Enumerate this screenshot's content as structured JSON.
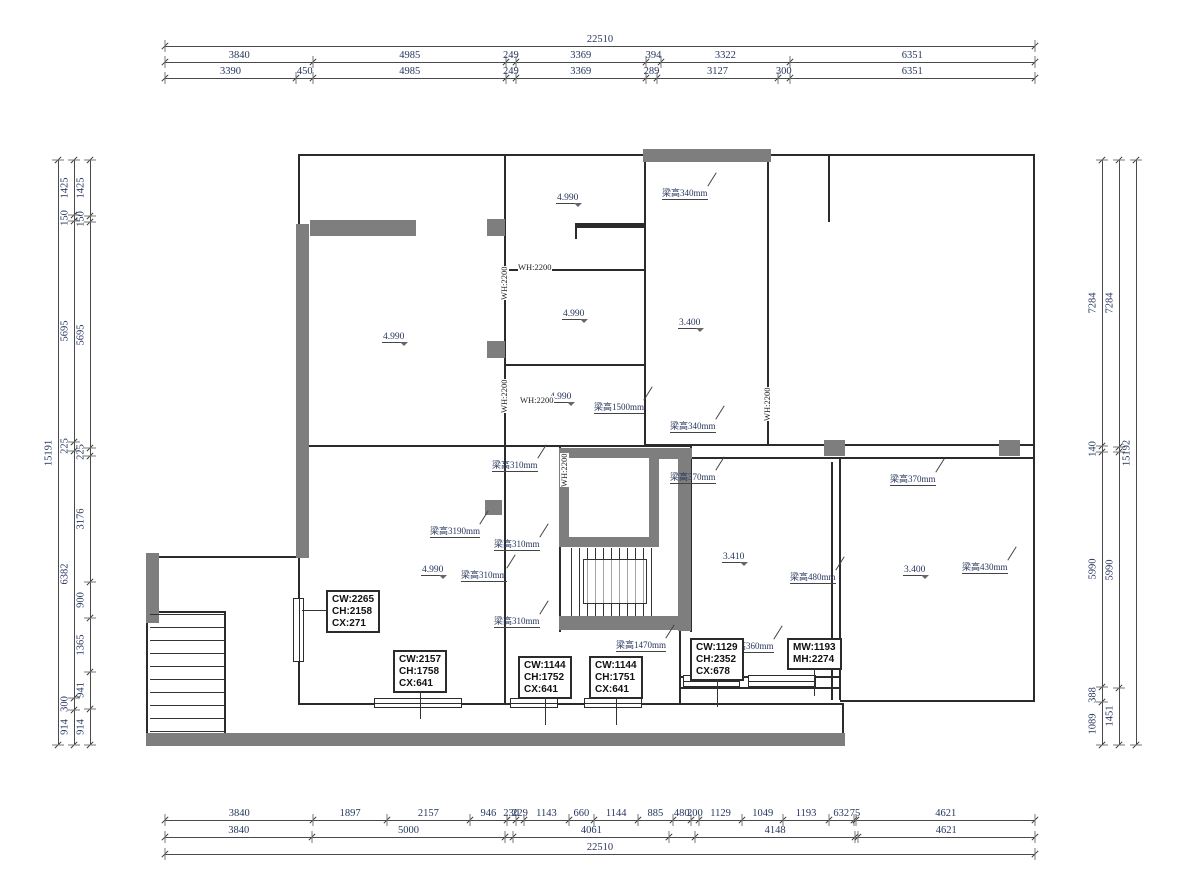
{
  "title": "residential floor plan working drawing",
  "colors": {
    "wall": "#2b2b2b",
    "poche": "#7e7e7e",
    "dim_text": "#26365e",
    "box_border": "#2b2b2b"
  },
  "dims": {
    "top": [
      {
        "name": "top-overall",
        "x": 165,
        "y": 46,
        "len": 870,
        "segments": [
          {
            "label": "22510",
            "size": 22510
          }
        ]
      },
      {
        "name": "top-row-2",
        "x": 165,
        "y": 62,
        "len": 870,
        "segments": [
          {
            "label": "3840",
            "size": 3840
          },
          {
            "label": "4985",
            "size": 4985
          },
          {
            "label": "249",
            "size": 249
          },
          {
            "label": "3369",
            "size": 3369
          },
          {
            "label": "394",
            "size": 394
          },
          {
            "label": "3322",
            "size": 3322
          },
          {
            "label": "6351",
            "size": 6351
          }
        ]
      },
      {
        "name": "top-row-3",
        "x": 165,
        "y": 78,
        "len": 870,
        "segments": [
          {
            "label": "3390",
            "size": 3390
          },
          {
            "label": "450",
            "size": 450
          },
          {
            "label": "4985",
            "size": 4985
          },
          {
            "label": "249",
            "size": 249
          },
          {
            "label": "3369",
            "size": 3369
          },
          {
            "label": "289",
            "size": 289
          },
          {
            "label": "3127",
            "size": 3127
          },
          {
            "label": "300",
            "size": 300
          },
          {
            "label": "6351",
            "size": 6351
          }
        ]
      }
    ],
    "bottom": [
      {
        "name": "bottom-row-1",
        "x": 165,
        "y": 820,
        "len": 870,
        "segments": [
          {
            "label": "3840",
            "size": 3840
          },
          {
            "label": "1897",
            "size": 1897
          },
          {
            "label": "2157",
            "size": 2157
          },
          {
            "label": "946",
            "size": 946
          },
          {
            "label": "230",
            "size": 230
          },
          {
            "label": "229",
            "size": 229
          },
          {
            "label": "1143",
            "size": 1143
          },
          {
            "label": "660",
            "size": 660
          },
          {
            "label": "1144",
            "size": 1144
          },
          {
            "label": "885",
            "size": 885
          },
          {
            "label": "480",
            "size": 480
          },
          {
            "label": "200",
            "size": 200
          },
          {
            "label": "1129",
            "size": 1129
          },
          {
            "label": "1049",
            "size": 1049
          },
          {
            "label": "1193",
            "size": 1193
          },
          {
            "label": "632",
            "size": 632
          },
          {
            "label": "75",
            "size": 75
          },
          {
            "label": "4621",
            "size": 4621
          }
        ]
      },
      {
        "name": "bottom-row-2",
        "x": 165,
        "y": 837,
        "len": 870,
        "segments": [
          {
            "label": "3840",
            "size": 3840
          },
          {
            "label": "5000",
            "size": 5000
          },
          {
            "label": "",
            "size": 230
          },
          {
            "label": "4061",
            "size": 4061
          },
          {
            "label": "",
            "size": 680
          },
          {
            "label": "4148",
            "size": 4148
          },
          {
            "label": "",
            "size": 70
          },
          {
            "label": "4621",
            "size": 4621
          }
        ]
      },
      {
        "name": "bottom-overall",
        "x": 165,
        "y": 854,
        "len": 870,
        "segments": [
          {
            "label": "22510",
            "size": 22510
          }
        ]
      }
    ],
    "left": [
      {
        "name": "left-overall",
        "x": 58,
        "y": 160,
        "len": 585,
        "segments": [
          {
            "label": "15191",
            "size": 15191
          }
        ]
      },
      {
        "name": "left-row-2",
        "x": 74,
        "y": 160,
        "len": 585,
        "segments": [
          {
            "label": "1425",
            "size": 1425
          },
          {
            "label": "150",
            "size": 150
          },
          {
            "label": "5695",
            "size": 5695
          },
          {
            "label": "225",
            "size": 225
          },
          {
            "label": "6382",
            "size": 6382
          },
          {
            "label": "300",
            "size": 300
          },
          {
            "label": "914",
            "size": 914
          }
        ]
      },
      {
        "name": "left-row-3",
        "x": 90,
        "y": 160,
        "len": 585,
        "segments": [
          {
            "label": "1425",
            "size": 1425
          },
          {
            "label": "150",
            "size": 150
          },
          {
            "label": "5695",
            "size": 5695
          },
          {
            "label": "225",
            "size": 225
          },
          {
            "label": "3176",
            "size": 3176
          },
          {
            "label": "900",
            "size": 900
          },
          {
            "label": "1365",
            "size": 1365
          },
          {
            "label": "941",
            "size": 941
          },
          {
            "label": "914",
            "size": 914
          }
        ]
      }
    ],
    "right": [
      {
        "name": "right-row-1",
        "x": 1102,
        "y": 160,
        "len": 585,
        "segments": [
          {
            "label": "7284",
            "size": 7284
          },
          {
            "label": "140",
            "size": 140
          },
          {
            "label": "5990",
            "size": 5990
          },
          {
            "label": "388",
            "size": 388
          },
          {
            "label": "1089",
            "size": 1089
          }
        ]
      },
      {
        "name": "right-row-2",
        "x": 1119,
        "y": 160,
        "len": 585,
        "segments": [
          {
            "label": "7284",
            "size": 7284
          },
          {
            "label": "",
            "size": 140
          },
          {
            "label": "5990",
            "size": 5990
          },
          {
            "label": "1451",
            "size": 1451
          }
        ]
      },
      {
        "name": "right-overall",
        "x": 1136,
        "y": 160,
        "len": 585,
        "segments": [
          {
            "label": "15192",
            "size": 15192
          }
        ]
      }
    ]
  },
  "levels": [
    {
      "value": "4.990",
      "x": 382,
      "y": 332
    },
    {
      "value": "4.990",
      "x": 556,
      "y": 193
    },
    {
      "value": "4.990",
      "x": 562,
      "y": 309
    },
    {
      "value": "4.990",
      "x": 549,
      "y": 392
    },
    {
      "value": "4.990",
      "x": 421,
      "y": 565
    },
    {
      "value": "3.400",
      "x": 678,
      "y": 318
    },
    {
      "value": "3.410",
      "x": 722,
      "y": 552
    },
    {
      "value": "3.400",
      "x": 903,
      "y": 565
    }
  ],
  "beams": [
    {
      "text": "梁高340mm",
      "x": 662,
      "y": 186
    },
    {
      "text": "梁高1500mm",
      "x": 594,
      "y": 400
    },
    {
      "text": "梁高340mm",
      "x": 670,
      "y": 419
    },
    {
      "text": "梁高370mm",
      "x": 670,
      "y": 470
    },
    {
      "text": "梁高310mm",
      "x": 492,
      "y": 458
    },
    {
      "text": "梁高3190mm",
      "x": 430,
      "y": 524
    },
    {
      "text": "梁高310mm",
      "x": 494,
      "y": 537
    },
    {
      "text": "梁高310mm",
      "x": 461,
      "y": 568
    },
    {
      "text": "梁高310mm",
      "x": 494,
      "y": 614
    },
    {
      "text": "梁高1470mm",
      "x": 616,
      "y": 638
    },
    {
      "text": "梁高360mm",
      "x": 728,
      "y": 639
    },
    {
      "text": "梁高480mm",
      "x": 790,
      "y": 570
    },
    {
      "text": "梁高370mm",
      "x": 890,
      "y": 472
    },
    {
      "text": "梁高430mm",
      "x": 962,
      "y": 560
    }
  ],
  "wh_labels": [
    {
      "text": "WH:2200",
      "x": 518,
      "y": 263,
      "rot": 0
    },
    {
      "text": "WH:2200",
      "x": 520,
      "y": 396,
      "rot": 0
    },
    {
      "text": "WH:2200",
      "x": 500,
      "y": 300,
      "rot": 90
    },
    {
      "text": "WH:2200",
      "x": 500,
      "y": 413,
      "rot": 90
    },
    {
      "text": "WH:2200",
      "x": 560,
      "y": 487,
      "rot": 90
    },
    {
      "text": "WH:2200",
      "x": 763,
      "y": 421,
      "rot": 90
    }
  ],
  "spec_boxes": [
    {
      "lines": [
        "CW:2265",
        "CH:2158",
        "CX:271"
      ],
      "x": 326,
      "y": 590,
      "leader": "left"
    },
    {
      "lines": [
        "CW:2157",
        "CH:1758",
        "CX:641"
      ],
      "x": 393,
      "y": 650,
      "leader": "down"
    },
    {
      "lines": [
        "CW:1144",
        "CH:1752",
        "CX:641"
      ],
      "x": 518,
      "y": 656,
      "leader": "down"
    },
    {
      "lines": [
        "CW:1144",
        "CH:1751",
        "CX:641"
      ],
      "x": 589,
      "y": 656,
      "leader": "down"
    },
    {
      "lines": [
        "CW:1129",
        "CH:2352",
        "CX:678"
      ],
      "x": 690,
      "y": 638,
      "leader": "down"
    },
    {
      "lines": [
        "MW:1193",
        "MH:2274"
      ],
      "x": 787,
      "y": 638,
      "leader": "down"
    }
  ]
}
